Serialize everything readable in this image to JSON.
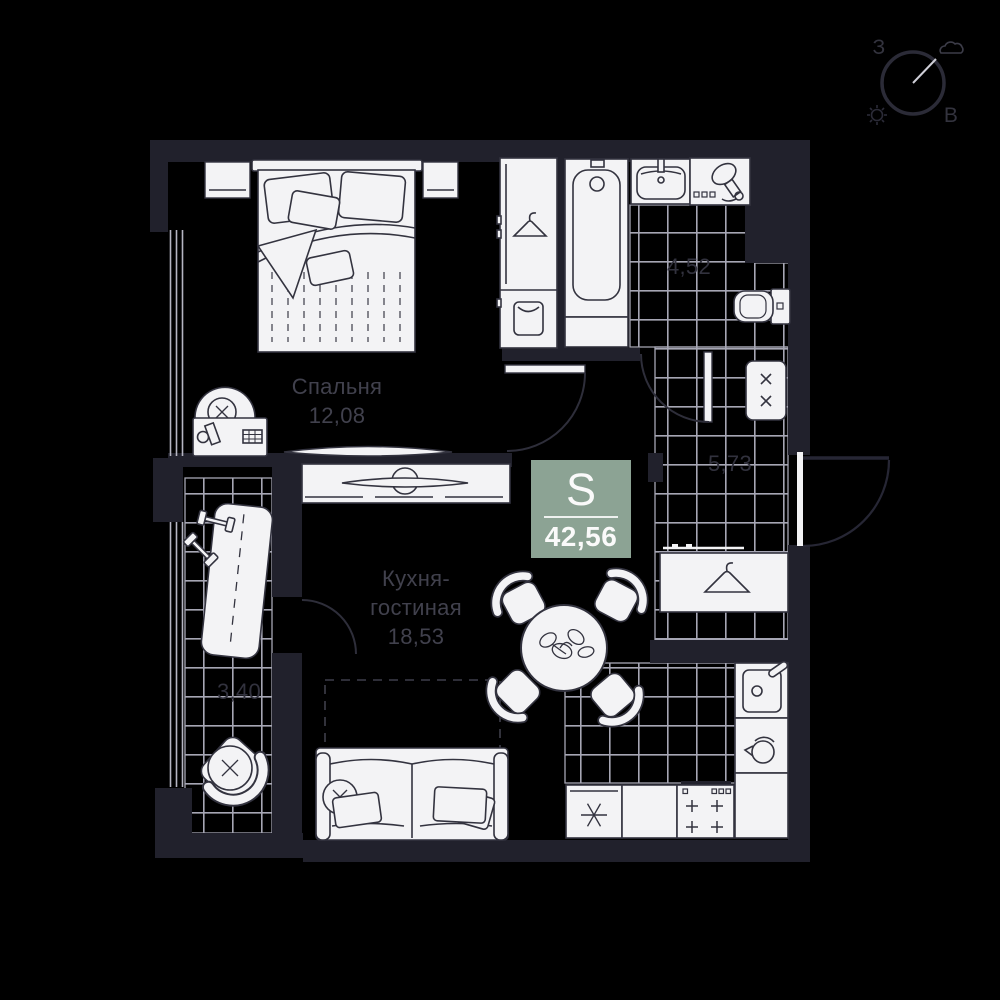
{
  "compass": {
    "west": "З",
    "east": "В"
  },
  "badge": {
    "label": "S",
    "value": "42,56"
  },
  "rooms": {
    "bedroom": {
      "name": "Спальня",
      "area": "12,08"
    },
    "kitchen_living": {
      "name_line1": "Кухня-",
      "name_line2": "гостиная",
      "area": "18,53"
    },
    "bathroom": {
      "area": "4,52"
    },
    "hallway": {
      "area": "5,73"
    },
    "loggia": {
      "area": "3,40"
    }
  },
  "colors": {
    "background": "#000000",
    "wall": "#21212c",
    "furniture_fill": "#f3f3f5",
    "furniture_outline": "#33333f",
    "tile_line": "#a6a6b4",
    "room_label": "#41414d",
    "tile_dim_label": "#32323e",
    "badge_bg": "#8ca394",
    "badge_text": "#fafafa",
    "compass_label": "#33333e"
  },
  "icons": {
    "compass": "compass-icon",
    "sun": "sun-icon",
    "cloud": "cloud-icon",
    "bed": "double-bed-icon",
    "wardrobe": "wardrobe-icon",
    "vanity": "vanity-desk-icon",
    "tv": "tv-icon",
    "bathtub": "bathtub-icon",
    "sink": "sink-icon",
    "hairdryer": "hairdryer-icon",
    "toilet": "toilet-icon",
    "washer": "washing-machine-icon",
    "closet": "hanger-closet-icon",
    "table": "dining-table-icon",
    "sofa": "sofa-icon",
    "fridge": "fridge-icon",
    "stove": "stove-icon",
    "kettle": "kettle-icon",
    "bench": "exercise-bench-icon",
    "armchair": "armchair-icon"
  }
}
